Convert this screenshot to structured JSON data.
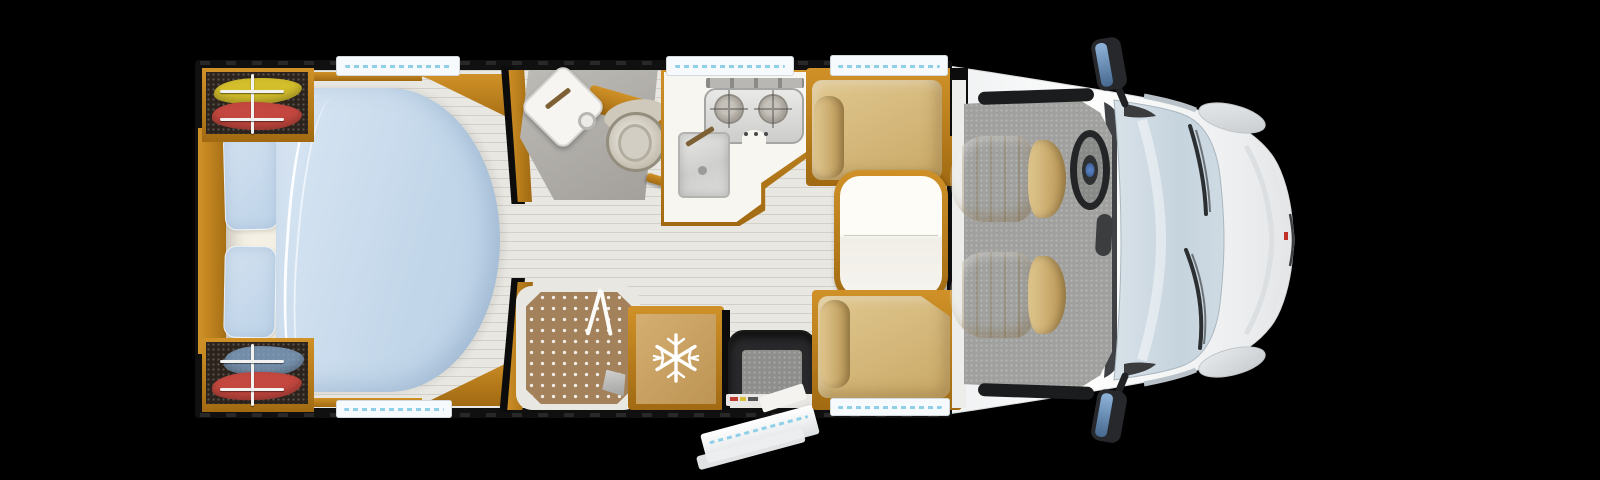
{
  "scene": {
    "type": "motorhome-floorplan-top-view",
    "orientation": "vehicle front on right, rear on left"
  },
  "palette": {
    "bg": "#000000",
    "wall": "#101010",
    "dark": "#0c0c0c",
    "wood_hi": "#d09127",
    "wood_lo": "#a16a12",
    "floor": "#e9e7e1",
    "plank": "rgba(110,105,95,0.18)",
    "duvet_hi": "#d9e6f3",
    "duvet_lo": "#c3d7ea",
    "pillow_hi": "#d3e1f0",
    "pillow_lo": "#bdd3e8",
    "sheet": "#f4f0e3",
    "seat_hi": "#e0c78f",
    "seat_lo": "#c9a967",
    "seat_dark": "#b89452",
    "table_top": "#fdfcf7",
    "counter": "#f8f6f0",
    "steel_hi": "#e9e9e7",
    "steel_lo": "#cdcdcb",
    "steel_mid": "#b9b7b3",
    "bath_hi": "#bdbbb6",
    "bath_lo": "#a29f9b",
    "tray": "#a3815a",
    "fridge_hi": "#d4ae72",
    "fridge_lo": "#bd9453",
    "cab_floor": "#a0a19f",
    "well": "#29292b",
    "gray_mat": "#8e8f8d",
    "glass_hi": "#d6e0e8",
    "glass_lo": "#c2d1db",
    "body_hi": "#fdfdfd",
    "body_lo": "#e9ebed",
    "mirror_hi": "#8fb4da",
    "mirror_lo": "#47688f",
    "window_white": "#f7fafc",
    "window_dash": "#8fd0e8",
    "cloth_yellow": "#d3be2c",
    "cloth_red": "#c4483f",
    "cloth_blue": "#86a8cc",
    "trim_dark": "#232527",
    "white": "#ffffff"
  },
  "icons": {
    "fridge_badge": "snowflake-icon",
    "steering": "steering-wheel-icon"
  },
  "zones": [
    "bedroom",
    "wardrobes",
    "washroom",
    "shower",
    "kitchen",
    "fridge",
    "entry-step",
    "dinette",
    "cab"
  ]
}
